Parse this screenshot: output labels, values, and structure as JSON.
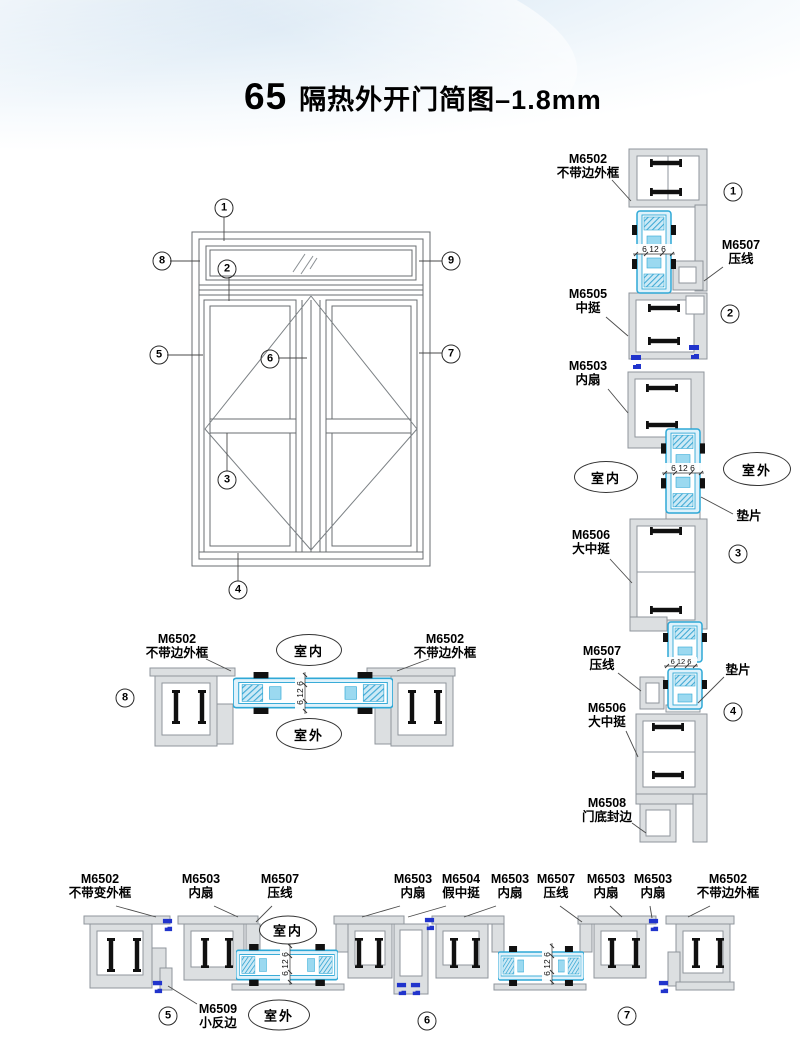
{
  "header": {
    "doc_number": "65",
    "title": "隔热外开门简图–1.8mm"
  },
  "labels": {
    "indoor": "室内",
    "outdoor": "室外",
    "gasket": "垫片"
  },
  "glass_dim": "6 12 6",
  "elevation": {
    "callouts": [
      "1",
      "2",
      "3",
      "4",
      "5",
      "6",
      "7",
      "8",
      "9"
    ]
  },
  "vertical_section": {
    "callouts": [
      "1",
      "2",
      "3",
      "4"
    ],
    "parts": [
      {
        "code": "M6502",
        "name": "不带边外框"
      },
      {
        "code": "M6507",
        "name": "压线"
      },
      {
        "code": "M6505",
        "name": "中挺"
      },
      {
        "code": "M6503",
        "name": "内扇"
      },
      {
        "code": "M6506",
        "name": "大中挺"
      },
      {
        "code": "M6507",
        "name": "压线"
      },
      {
        "code": "M6506",
        "name": "大中挺"
      },
      {
        "code": "M6508",
        "name": "门底封边"
      }
    ]
  },
  "section_8": {
    "callout": "8",
    "left_part": {
      "code": "M6502",
      "name": "不带边外框"
    },
    "right_part": {
      "code": "M6502",
      "name": "不带边外框"
    }
  },
  "bottom_section": {
    "callouts": [
      "5",
      "6",
      "7"
    ],
    "parts": [
      {
        "code": "M6502",
        "name": "不带变外框"
      },
      {
        "code": "M6503",
        "name": "内扇"
      },
      {
        "code": "M6507",
        "name": "压线"
      },
      {
        "code": "M6503",
        "name": "内扇"
      },
      {
        "code": "M6504",
        "name": "假中挺"
      },
      {
        "code": "M6503",
        "name": "内扇"
      },
      {
        "code": "M6507",
        "name": "压线"
      },
      {
        "code": "M6503",
        "name": "内扇"
      },
      {
        "code": "M6503",
        "name": "内扇"
      },
      {
        "code": "M6502",
        "name": "不带边外框"
      }
    ],
    "flip_part": {
      "code": "M6509",
      "name": "小反边"
    }
  },
  "colors": {
    "glass_fill": "#dff2fb",
    "glass_stroke": "#2fa8d6",
    "profile_fill": "#dcdfe1",
    "profile_stroke": "#8f969c",
    "clip_blue": "#2134cc",
    "thermal_break": "#101010"
  }
}
